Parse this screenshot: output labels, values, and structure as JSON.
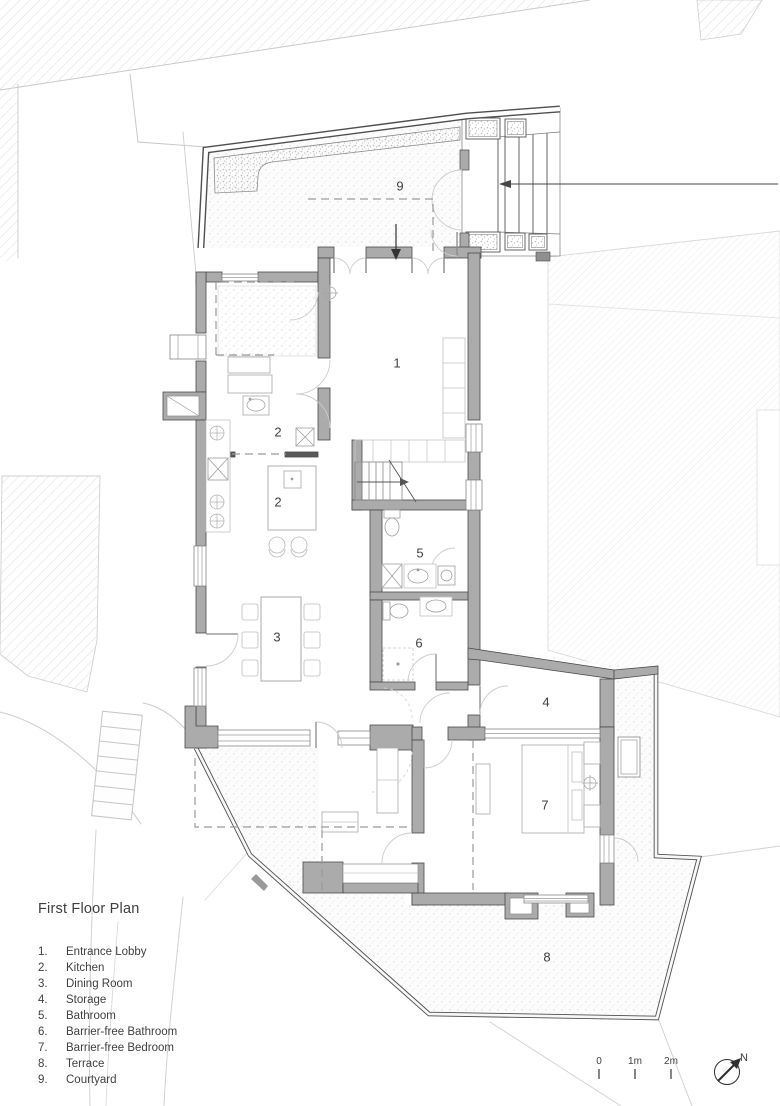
{
  "title": "First Floor Plan",
  "legend": {
    "items": [
      {
        "number": "1.",
        "label": "Entrance Lobby"
      },
      {
        "number": "2.",
        "label": "Kitchen"
      },
      {
        "number": "3.",
        "label": "Dining Room"
      },
      {
        "number": "4.",
        "label": "Storage"
      },
      {
        "number": "5.",
        "label": "Bathroom"
      },
      {
        "number": "6.",
        "label": "Barrier-free Bathroom"
      },
      {
        "number": "7.",
        "label": "Barrier-free Bedroom"
      },
      {
        "number": "8.",
        "label": "Terrace"
      },
      {
        "number": "9.",
        "label": "Courtyard"
      }
    ]
  },
  "room_labels": [
    {
      "text": "1"
    },
    {
      "text": "2"
    },
    {
      "text": "2"
    },
    {
      "text": "3"
    },
    {
      "text": "4"
    },
    {
      "text": "5"
    },
    {
      "text": "6"
    },
    {
      "text": "7"
    },
    {
      "text": "8"
    },
    {
      "text": "9"
    }
  ],
  "scale_bar": {
    "labels": [
      "0",
      "1m",
      "2m"
    ]
  },
  "north_label": "N",
  "colors": {
    "wall_fill": "#ababab",
    "wall_outline": "#4a4a4a",
    "site_line": "#c9c9c9",
    "hatch_line": "#dedede",
    "text": "#3f3f3f"
  }
}
